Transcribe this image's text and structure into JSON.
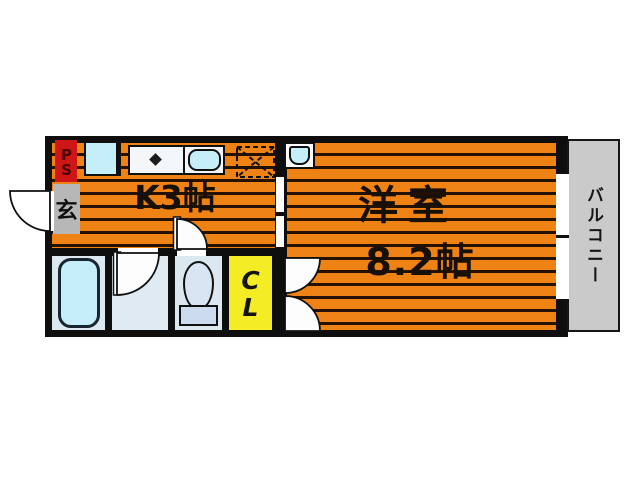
{
  "plan": {
    "rooms": {
      "kitchen": {
        "label": "K3帖"
      },
      "western_room": {
        "name": "洋室",
        "size": "8.2帖"
      },
      "closet": {
        "label": "CL"
      },
      "balcony": {
        "label": "バルコニー"
      },
      "entrance": {
        "label": "玄"
      },
      "pipe_space": {
        "label": "PS"
      }
    },
    "colors": {
      "floor_orange": "#ee8215",
      "floor_stripe": "#241102",
      "wall_black": "#0e0e0e",
      "closet_yellow": "#f4ec25",
      "pipe_space_red": "#cf1616",
      "entrance_gray": "#b7b7b7",
      "balcony_gray": "#cacaca",
      "wet_room_blue": "#dbe8f0",
      "fixture_cyan": "#c6eef8"
    }
  }
}
